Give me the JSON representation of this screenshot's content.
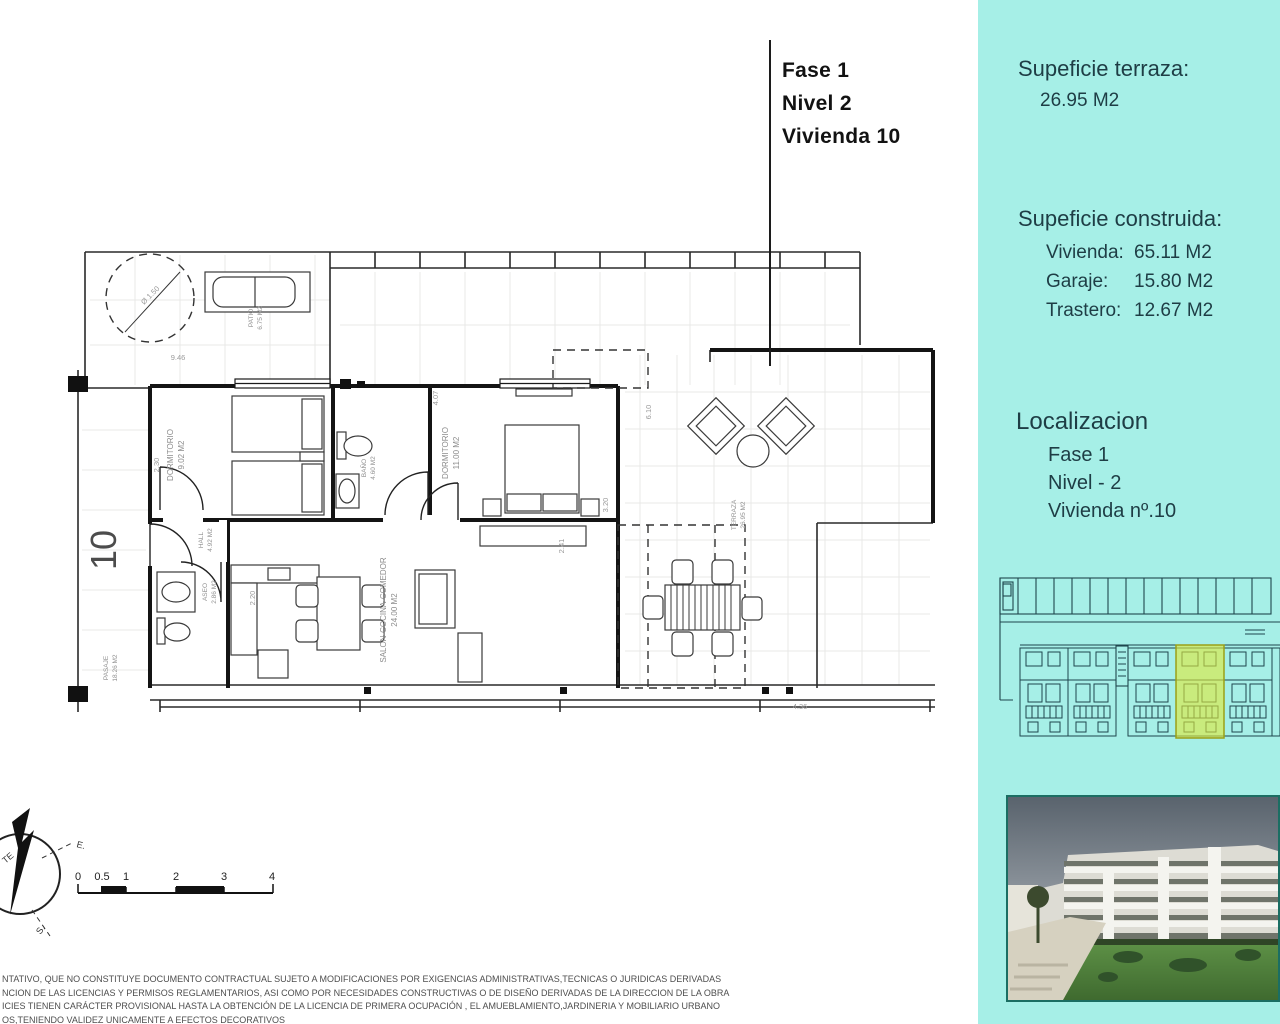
{
  "title_block": {
    "lines": [
      "Fase 1",
      "Nivel 2",
      "Vivienda  10"
    ]
  },
  "sidebar": {
    "accent_bg": "#a6efe7",
    "text_color": "#1e3d45",
    "terrace_heading": "Supeficie terraza:",
    "terrace_value": "26.95 M2",
    "built_heading": "Supeficie construida:",
    "built_rows": [
      {
        "label": "Vivienda:",
        "value": "65.11 M2"
      },
      {
        "label": "Garaje:",
        "value": "15.80 M2"
      },
      {
        "label": "Trastero:",
        "value": "12.67 M2"
      }
    ],
    "location_heading": "Localizacion",
    "location_lines": [
      "Fase 1",
      "Nivel - 2",
      "Vivienda nº.10"
    ],
    "siteplan_highlight_color": "#dfe93b"
  },
  "floor_plan": {
    "unit_number": "10",
    "rooms": {
      "dormitorio1": {
        "name": "DORMITORIO",
        "area": "9.02 M2"
      },
      "bano": {
        "name": "BAÑO",
        "area": "4.60 M2"
      },
      "dormitorio2": {
        "name": "DORMITORIO",
        "area": "11.00 M2"
      },
      "salon": {
        "name": "SALON-COCINA-COMEDOR",
        "area": "24.00 M2"
      },
      "aseo": {
        "name": "ASEO",
        "area": "2.86 M2"
      },
      "hall": {
        "name": "HALL",
        "area": "4.92 M2"
      },
      "terraza": {
        "name": "TERRAZA",
        "area": "26.95 M2"
      },
      "patio": {
        "name": "PATIO",
        "area": "6.75 M2"
      },
      "pasaje": {
        "name": "PASAJE",
        "area": "18.26 M2"
      }
    },
    "dims": {
      "d946": "9.46",
      "d610": "6.10",
      "d320": "3.20",
      "d407": "4.07",
      "d230": "2.30",
      "d220": "2.20",
      "d436": "4.36",
      "d241": "2.41",
      "d150": "Ø 1.50"
    },
    "scale_labels": [
      "0",
      "0.5",
      "1",
      "2",
      "3",
      "4"
    ],
    "compass": {
      "north": "TE",
      "east": "E.",
      "south": "S."
    }
  },
  "disclaimer": {
    "lines": [
      "NTATIVO, QUE NO CONSTITUYE DOCUMENTO CONTRACTUAL SUJETO A MODIFICACIONES POR EXIGENCIAS ADMINISTRATIVAS,TECNICAS O JURIDICAS DERIVADAS",
      "NCION DE LAS LICENCIAS Y PERMISOS REGLAMENTARIOS, ASI COMO POR NECESIDADES CONSTRUCTIVAS  O DE DISEÑO DERIVADAS DE LA DIRECCION DE LA OBRA",
      "ICIES TIENEN CARÁCTER PROVISIONAL HASTA LA OBTENCIÓN DE LA LICENCIA DE PRIMERA OCUPACIÓN , EL AMUEBLAMIENTO,JARDINERIA Y MOBILIARIO URBANO",
      "OS,TENIENDO VALIDEZ UNICAMENTE  A EFECTOS DECORATIVOS"
    ]
  }
}
